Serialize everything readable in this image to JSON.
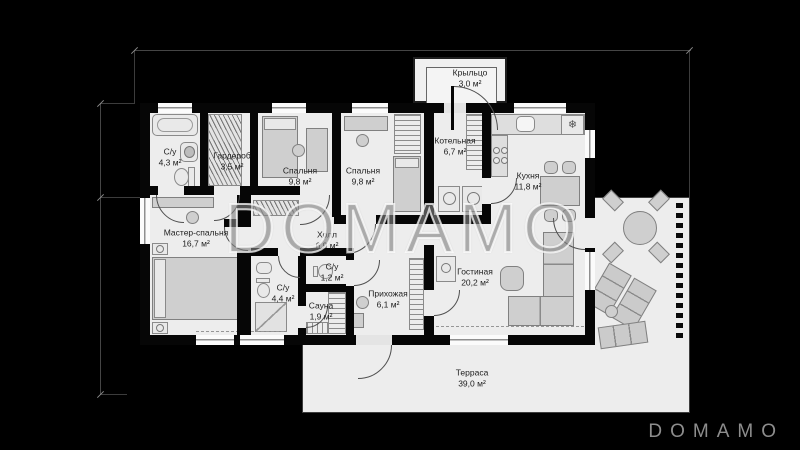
{
  "watermark": {
    "text": "DOMAMO"
  },
  "brand": {
    "logo": "DOMAMO"
  },
  "icons": {
    "snowflake": "❄"
  },
  "colors": {
    "background": "#000000",
    "floor": "#ededed",
    "wall": "#060606",
    "window": "#fbfbfb",
    "furniture": "#cfcfcf",
    "dimension_line": "#454545",
    "label_text": "#1d1d1d",
    "watermark_stroke": "#ffffff",
    "logo_text": "#8d8d8d"
  },
  "rooms": {
    "porch": {
      "name": "Крыльцо",
      "area": "3,0 м²"
    },
    "bath1": {
      "name": "С/у",
      "area": "4,3 м²"
    },
    "wardrobe": {
      "name": "Гардероб",
      "area": "3,5 м²"
    },
    "bedroom1": {
      "name": "Спальня",
      "area": "9,8 м²"
    },
    "bedroom2": {
      "name": "Спальня",
      "area": "9,8 м²"
    },
    "boiler": {
      "name": "Котельная",
      "area": "6,7 м²"
    },
    "kitchen": {
      "name": "Кухня",
      "area": "11,8 м²"
    },
    "master": {
      "name": "Мастер-спальня",
      "area": "16,7 м²"
    },
    "hall": {
      "name": "Холл",
      "area": "6,9 м²"
    },
    "wc": {
      "name": "С/у",
      "area": "1,2 м²"
    },
    "bath2": {
      "name": "С/у",
      "area": "4,4 м²"
    },
    "sauna": {
      "name": "Сауна",
      "area": "1,9 м²"
    },
    "entry": {
      "name": "Прихожая",
      "area": "6,1 м²"
    },
    "living": {
      "name": "Гостиная",
      "area": "20,2 м²"
    },
    "terrace": {
      "name": "Терраса",
      "area": "39,0 м²"
    }
  }
}
